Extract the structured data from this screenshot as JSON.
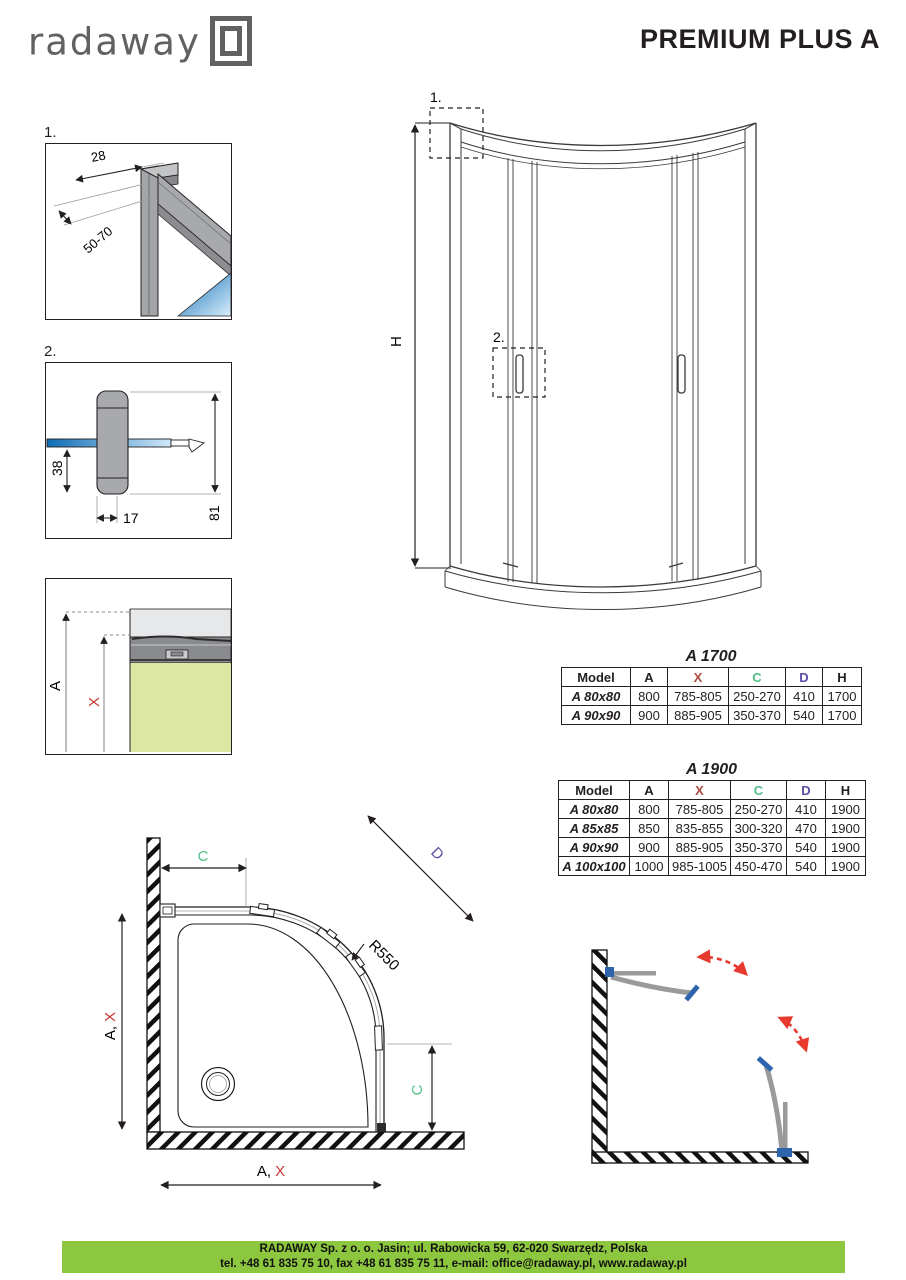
{
  "header": {
    "logo_text": "radaway",
    "title": "PREMIUM PLUS A"
  },
  "details": {
    "d1": {
      "label": "1.",
      "dim_width": "28",
      "dim_range": "50-70"
    },
    "d2": {
      "label": "2.",
      "dim_height": "38",
      "dim_depth": "17",
      "dim_total": "81"
    },
    "d3": {
      "dim_a": "A",
      "dim_x": "X"
    }
  },
  "elevation": {
    "callout1": "1.",
    "callout2": "2.",
    "dim_h": "H"
  },
  "plan": {
    "dim_c": "C",
    "dim_d": "D",
    "radius": "R550",
    "dim_a_prefix": "A,",
    "dim_x": "X"
  },
  "tables": [
    {
      "title": "A 1700",
      "headers": [
        "Model",
        "A",
        "X",
        "C",
        "D",
        "H"
      ],
      "rows": [
        [
          "A 80x80",
          "800",
          "785-805",
          "250-270",
          "410",
          "1700"
        ],
        [
          "A 90x90",
          "900",
          "885-905",
          "350-370",
          "540",
          "1700"
        ]
      ]
    },
    {
      "title": "A 1900",
      "headers": [
        "Model",
        "A",
        "X",
        "C",
        "D",
        "H"
      ],
      "rows": [
        [
          "A 80x80",
          "800",
          "785-805",
          "250-270",
          "410",
          "1900"
        ],
        [
          "A 85x85",
          "850",
          "835-855",
          "300-320",
          "470",
          "1900"
        ],
        [
          "A 90x90",
          "900",
          "885-905",
          "350-370",
          "540",
          "1900"
        ],
        [
          "A 100x100",
          "1000",
          "985-1005",
          "450-470",
          "540",
          "1900"
        ]
      ]
    }
  ],
  "footer": {
    "line1": "RADAWAY Sp. z o. o. Jasin; ul. Rabowicka 59, 62-020 Swarzędz, Polska",
    "line2": "tel. +48 61 835 75 10, fax +48 61 835 75 11, e-mail: office@radaway.pl, www.radaway.pl"
  },
  "colors": {
    "footer_green": "#8dc63f",
    "dim_x_red": "#c4342f",
    "dim_c_green": "#52bd85",
    "dim_d_purple": "#5a4fa5",
    "glass_blue": "#1272b8",
    "handle_blue": "#2e64ae",
    "arrow_red": "#e8392f",
    "tray_green": "#dbe7a3",
    "profile_gray": "#9a9c9e",
    "logo_gray": "#5f6163"
  }
}
